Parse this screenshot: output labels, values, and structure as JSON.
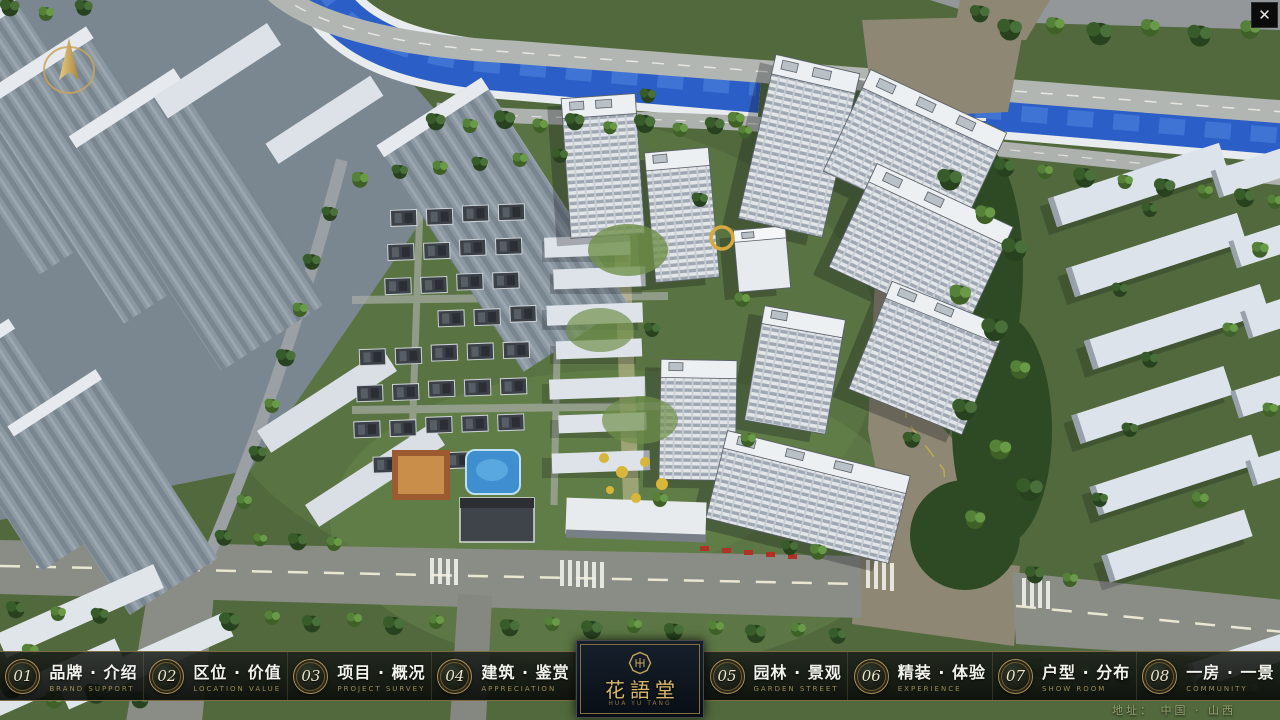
{
  "window": {
    "close_glyph": "✕"
  },
  "menu": {
    "items": [
      {
        "num": "01",
        "label": "品牌 · 介绍",
        "sub": "BRAND SUPPORT"
      },
      {
        "num": "02",
        "label": "区位 · 价值",
        "sub": "LOCATION VALUE"
      },
      {
        "num": "03",
        "label": "项目 · 概况",
        "sub": "PROJECT SURVEY"
      },
      {
        "num": "04",
        "label": "建筑 · 鉴赏",
        "sub": "APPRECIATION"
      },
      {
        "num": "05",
        "label": "园林 · 景观",
        "sub": "GARDEN STREET"
      },
      {
        "num": "06",
        "label": "精装 · 体验",
        "sub": "EXPERIENCE"
      },
      {
        "num": "07",
        "label": "户型 · 分布",
        "sub": "SHOW ROOM"
      },
      {
        "num": "08",
        "label": "一房 · 一景",
        "sub": "COMMUNITY"
      }
    ]
  },
  "logo": {
    "title": "花語堂",
    "subtitle": "HUA YU TANG"
  },
  "footer": {
    "address": "地址：  中国 · 山西"
  },
  "colors": {
    "gold": "#c9a85e",
    "river": "#2b5ec6",
    "bar_bg": "#141814"
  }
}
